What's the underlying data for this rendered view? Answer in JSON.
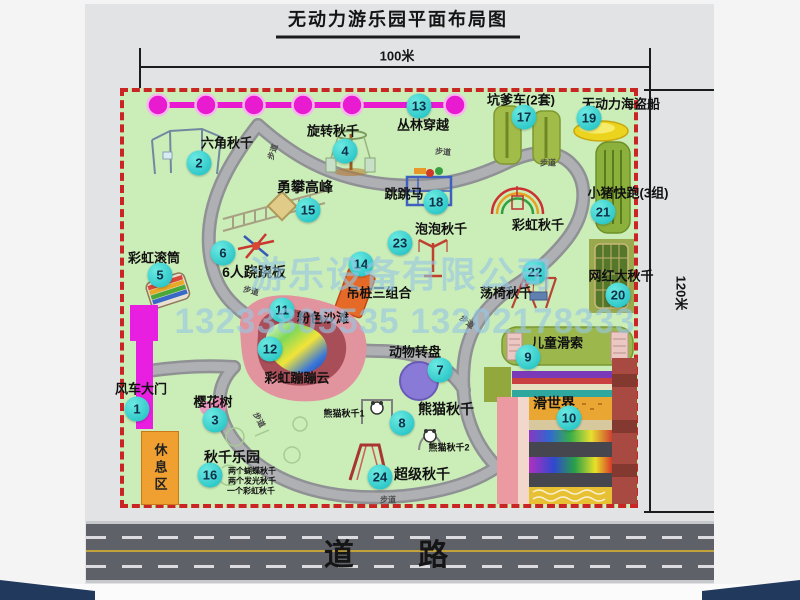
{
  "title": "无动力游乐园平面布局图",
  "dimensions": {
    "width_label": "100米",
    "height_label": "120米"
  },
  "watermark": {
    "company": "游乐设备有限公司",
    "phone": "13233805535 13202178333"
  },
  "road": {
    "label": "道 路"
  },
  "map": {
    "rest_area_label": "休息区",
    "path_label": "步道",
    "path_label_positions": [
      {
        "x": 273,
        "y": 152,
        "rot": -72
      },
      {
        "x": 443,
        "y": 152,
        "rot": 5
      },
      {
        "x": 548,
        "y": 163,
        "rot": 0
      },
      {
        "x": 251,
        "y": 291,
        "rot": 15
      },
      {
        "x": 467,
        "y": 322,
        "rot": 38
      },
      {
        "x": 259,
        "y": 420,
        "rot": 62
      },
      {
        "x": 388,
        "y": 500,
        "rot": 0
      }
    ],
    "features": [
      {
        "num": "1",
        "id": "windmill-gate",
        "name": "风车大门",
        "label": {
          "x": 141,
          "y": 388,
          "size": 13
        },
        "badge": {
          "x": 137,
          "y": 409
        }
      },
      {
        "num": "2",
        "id": "hexagon-swing",
        "name": "六角秋千",
        "label": {
          "x": 227,
          "y": 142,
          "size": 13
        },
        "badge": {
          "x": 199,
          "y": 163
        }
      },
      {
        "num": "3",
        "id": "cherry-tree",
        "name": "樱花树",
        "label": {
          "x": 213,
          "y": 401,
          "size": 13
        },
        "badge": {
          "x": 215,
          "y": 420
        }
      },
      {
        "num": "4",
        "id": "rotating-swing",
        "name": "旋转秋千",
        "label": {
          "x": 333,
          "y": 130,
          "size": 13
        },
        "badge": {
          "x": 345,
          "y": 151
        }
      },
      {
        "num": "5",
        "id": "rainbow-roller",
        "name": "彩虹滚筒",
        "label": {
          "x": 154,
          "y": 257,
          "size": 13
        },
        "badge": {
          "x": 160,
          "y": 275
        }
      },
      {
        "num": "6",
        "id": "six-person-seesaw",
        "name": "6人跷跷板",
        "label": {
          "x": 254,
          "y": 272,
          "size": 14
        },
        "badge": {
          "x": 223,
          "y": 253
        }
      },
      {
        "num": "7",
        "id": "animal-turntable",
        "name": "动物转盘",
        "label": {
          "x": 415,
          "y": 351,
          "size": 13
        },
        "badge": {
          "x": 440,
          "y": 370
        }
      },
      {
        "num": "8",
        "id": "panda-swing",
        "name": "熊猫秋千",
        "label": {
          "x": 446,
          "y": 409,
          "size": 14
        },
        "badge": {
          "x": 402,
          "y": 423
        }
      },
      {
        "num": "9",
        "id": "kids-zipline",
        "name": "儿童滑索",
        "label": {
          "x": 557,
          "y": 342,
          "size": 13
        },
        "badge": {
          "x": 528,
          "y": 357
        }
      },
      {
        "num": "10",
        "id": "slide-world",
        "name": "滑世界",
        "label": {
          "x": 554,
          "y": 403,
          "size": 14
        },
        "badge": {
          "x": 569,
          "y": 418
        }
      },
      {
        "num": "11",
        "id": "pink-beach",
        "name": "粉色沙滩",
        "label": {
          "x": 323,
          "y": 317,
          "size": 13
        },
        "badge": {
          "x": 282,
          "y": 310
        }
      },
      {
        "num": "12",
        "id": "rainbow-bounce-cloud",
        "name": "彩虹蹦蹦云",
        "label": {
          "x": 297,
          "y": 377,
          "size": 13
        },
        "badge": {
          "x": 270,
          "y": 349
        }
      },
      {
        "num": "13",
        "id": "jungle-crossing",
        "name": "丛林穿越",
        "label": {
          "x": 423,
          "y": 124,
          "size": 13
        },
        "badge": {
          "x": 419,
          "y": 106
        }
      },
      {
        "num": "14",
        "id": "hanging-piles-combo",
        "name": "吊桩三组合",
        "label": {
          "x": 379,
          "y": 292,
          "size": 13
        },
        "badge": {
          "x": 361,
          "y": 264
        }
      },
      {
        "num": "15",
        "id": "climbing-peak",
        "name": "勇攀高峰",
        "label": {
          "x": 305,
          "y": 187,
          "size": 14
        },
        "badge": {
          "x": 308,
          "y": 210
        }
      },
      {
        "num": "16",
        "id": "swing-park",
        "name": "秋千乐园",
        "label": {
          "x": 232,
          "y": 457,
          "size": 14
        },
        "badge": {
          "x": 210,
          "y": 475
        }
      },
      {
        "num": "17",
        "id": "pit-cars",
        "name": "坑爹车(2套)",
        "label": {
          "x": 521,
          "y": 99,
          "size": 13
        },
        "badge": {
          "x": 524,
          "y": 117
        }
      },
      {
        "num": "18",
        "id": "jumping-horse",
        "name": "跳跳马",
        "label": {
          "x": 404,
          "y": 193,
          "size": 13
        },
        "badge": {
          "x": 436,
          "y": 202
        }
      },
      {
        "num": "19",
        "id": "pirate-ship",
        "name": "无动力海盗船",
        "label": {
          "x": 621,
          "y": 103,
          "size": 13
        },
        "badge": {
          "x": 589,
          "y": 118
        }
      },
      {
        "num": "20",
        "id": "big-net-swing",
        "name": "网红大秋千",
        "label": {
          "x": 621,
          "y": 275,
          "size": 13
        },
        "badge": {
          "x": 618,
          "y": 295
        }
      },
      {
        "num": "21",
        "id": "piggy-run",
        "name": "小猪快跑(3组)",
        "label": {
          "x": 628,
          "y": 192,
          "size": 13
        },
        "badge": {
          "x": 603,
          "y": 212
        }
      },
      {
        "num": "22",
        "id": "chair-swing",
        "name": "荡椅秋千",
        "label": {
          "x": 506,
          "y": 292,
          "size": 13
        },
        "badge": {
          "x": 535,
          "y": 272
        }
      },
      {
        "num": "23",
        "id": "bubble-swing",
        "name": "泡泡秋千",
        "label": {
          "x": 441,
          "y": 228,
          "size": 13
        },
        "badge": {
          "x": 400,
          "y": 243
        }
      },
      {
        "num": "24",
        "id": "super-swing",
        "name": "超级秋千",
        "label": {
          "x": 422,
          "y": 474,
          "size": 14
        },
        "badge": {
          "x": 380,
          "y": 477
        }
      },
      {
        "num": null,
        "id": "rainbow-swing",
        "name": "彩虹秋千",
        "label": {
          "x": 538,
          "y": 224,
          "size": 13
        },
        "badge": null
      },
      {
        "num": null,
        "id": "panda-swing-1",
        "name": "熊猫秋千1",
        "label": {
          "x": 344,
          "y": 413,
          "size": 9
        },
        "badge": null
      },
      {
        "num": null,
        "id": "panda-swing-2",
        "name": "熊猫秋千2",
        "label": {
          "x": 449,
          "y": 447,
          "size": 9
        },
        "badge": null
      },
      {
        "num": null,
        "id": "swing-park-note-1",
        "name": "两个蝴蝶秋千",
        "label": {
          "x": 252,
          "y": 471,
          "size": 8
        },
        "badge": null
      },
      {
        "num": null,
        "id": "swing-park-note-2",
        "name": "两个发光秋千",
        "label": {
          "x": 252,
          "y": 481,
          "size": 8
        },
        "badge": null
      },
      {
        "num": null,
        "id": "swing-park-note-3",
        "name": "一个彩虹秋千",
        "label": {
          "x": 251,
          "y": 491,
          "size": 8
        },
        "badge": null
      }
    ]
  }
}
